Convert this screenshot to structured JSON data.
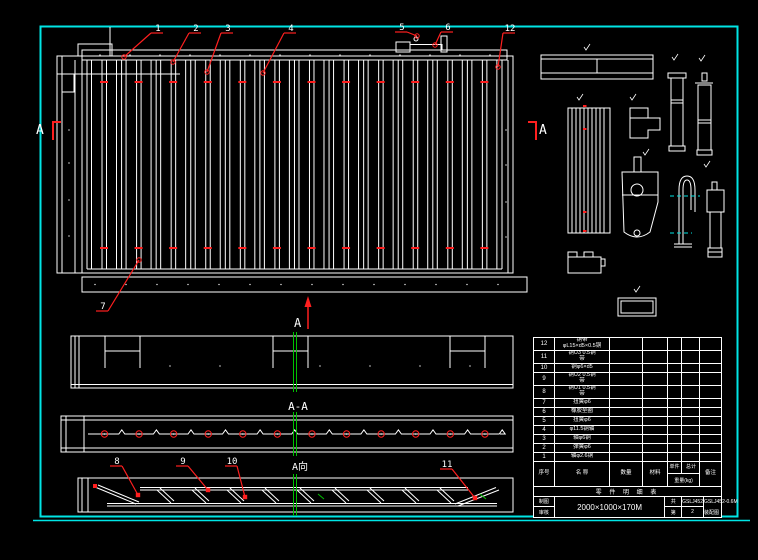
{
  "sheet": {
    "background": "#000000",
    "border_color": "#00E5E5",
    "line_color": "#FFFFFF",
    "callout_color": "#FF1F1F",
    "centerline_color": "#00C000"
  },
  "labels": {
    "section_a_left": "A",
    "section_a_right": "A",
    "view_arrow": "A",
    "section_aa": "A-A",
    "view_a": "A向"
  },
  "callouts": [
    "1",
    "2",
    "3",
    "4",
    "5",
    "6",
    "7",
    "8",
    "9",
    "10",
    "11",
    "12"
  ],
  "bom": {
    "header": {
      "no": "序号",
      "name": "名 称",
      "qty": "数量",
      "material": "材料",
      "unit": "单件",
      "total": "总计",
      "weight": "重量(kg)",
      "note": "备注"
    },
    "rows": [
      {
        "no": "12",
        "name": "铜带",
        "name2": "φL15×d5×0.5铜"
      },
      {
        "no": "11",
        "name": "铜U3 0.5铜",
        "name2": "带"
      },
      {
        "no": "10",
        "name": "铜φ6×d5",
        "name2": ""
      },
      {
        "no": "9",
        "name": "铜U2 0.5铜",
        "name2": "带"
      },
      {
        "no": "8",
        "name": "铜U1 0.5铜",
        "name2": "带"
      },
      {
        "no": "7",
        "name": "扭簧φ6",
        "name2": ""
      },
      {
        "no": "6",
        "name": "橡胶垫圈",
        "name2": ""
      },
      {
        "no": "5",
        "name": "扭簧φ6",
        "name2": ""
      },
      {
        "no": "4",
        "name": "φ11.5铜轴",
        "name2": ""
      },
      {
        "no": "3",
        "name": "轴φ6铜",
        "name2": ""
      },
      {
        "no": "2",
        "name": "弹簧φ6",
        "name2": ""
      },
      {
        "no": "1",
        "name": "轴φ2.6铜",
        "name2": ""
      }
    ],
    "banner": "零 件 明 细 表",
    "footer": {
      "drawn_label": "制图",
      "checked_label": "审核",
      "title": "2000×1000×170M",
      "sheet_label_1": "共",
      "sheet_value_1": "GSLJ452",
      "sheet_label_2": "第",
      "sheet_value_2": "2",
      "drawing_no": "GSLJ452-0.6M",
      "subtitle": "装配图"
    }
  }
}
